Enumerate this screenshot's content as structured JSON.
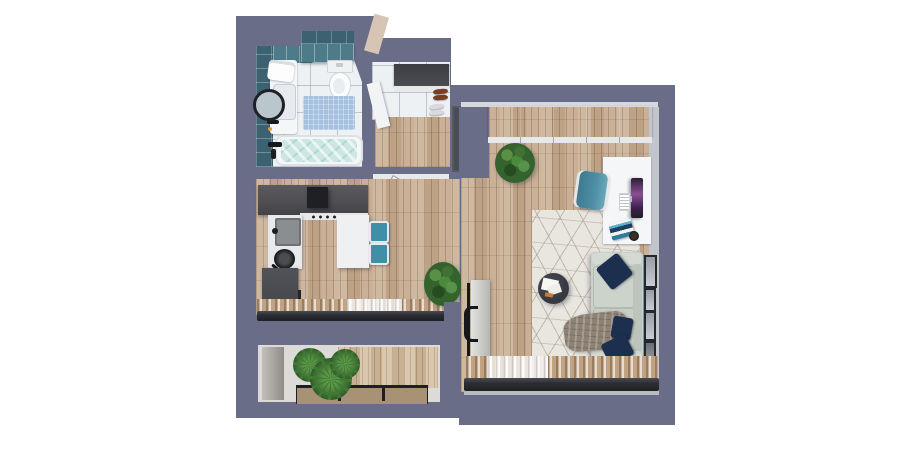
{
  "palette": {
    "background": "#ffffff",
    "wall": "#6a6d88",
    "wall_shadow": "#5d6078",
    "wall_face": "#c3c5cc",
    "trim": "#e7e8ea",
    "cut_beige": "#d6c5b5",
    "wood": "#c7ad92",
    "wood_deck": "#d3bd9f",
    "tile": "#eef1f4",
    "teal_tile": "#3c6272",
    "teal_tile_light": "#4e7b8a",
    "water": "#cde6e3",
    "bath_mat": "#a6c0e0",
    "fixture": "#f4f6f8",
    "counter_dark": "#505054",
    "hood": "#1f2023",
    "cabinet_dark": "#46474b",
    "island": "#eef0f2",
    "stool_teal": "#3f8fa6",
    "curtain_tan": "#c4a98c",
    "curtain_sheer": "#efece7",
    "rail": "#2c2e33",
    "door_dark": "#4b4d55",
    "door_leaf": "#ececee",
    "wardrobe_dark": "#6e7074",
    "entry_shelf_dark": "#4a4c52",
    "rug": "#e9e5df",
    "sofa": "#c9d0c8",
    "pillow_navy": "#1c2f4e",
    "throw": "#8e8274",
    "table_dark": "#35383e",
    "desk": "#f3f4f6",
    "screen_dark": "#1e1f24",
    "screen_purple": "#8a4f93",
    "chair_teal": "#4e8fa6",
    "plant_green": "#2f5a2c",
    "plant_light": "#5a8f46",
    "palm_green": "#3f7a33",
    "planter": "#a79276",
    "shoe_brown": "#7c3c20",
    "shoe_white": "#dadadc",
    "gold": "#d4a33c"
  },
  "plan": {
    "label": "Studio apartment 3D floor plan",
    "rooms": {
      "bathroom": {
        "label": "Bathroom"
      },
      "entry": {
        "label": "Entry hall"
      },
      "kitchen": {
        "label": "Kitchen"
      },
      "living": {
        "label": "Living room"
      },
      "balcony": {
        "label": "Balcony"
      }
    },
    "items": {
      "bathtub": {
        "label": "Bathtub with water"
      },
      "toilet": {
        "label": "Toilet"
      },
      "vanity": {
        "label": "Sink vanity"
      },
      "mirror": {
        "label": "Round mirror"
      },
      "bath_mat": {
        "label": "Blue bath mat"
      },
      "tiled_wall": {
        "label": "Teal tiled wall"
      },
      "entry_wardrobe": {
        "label": "Entry wardrobe with shelf"
      },
      "shoes": {
        "label": "Shoes"
      },
      "entrance_door": {
        "label": "Entrance door"
      },
      "interior_door": {
        "label": "Open interior door"
      },
      "counter": {
        "label": "Kitchen counter"
      },
      "hood": {
        "label": "Cooker hood"
      },
      "kitchen_sink": {
        "label": "Kitchen sink"
      },
      "pan": {
        "label": "Pan on counter"
      },
      "island": {
        "label": "Kitchen island table"
      },
      "stools": {
        "label": "Teal bar stools"
      },
      "kitchen_curtains": {
        "label": "Kitchen window curtains"
      },
      "living_curtains": {
        "label": "Living room window curtains"
      },
      "closet": {
        "label": "Built-in closet"
      },
      "desk": {
        "label": "Desk"
      },
      "monitor": {
        "label": "Monitor"
      },
      "keyboard": {
        "label": "Keyboard"
      },
      "books": {
        "label": "Stack of books"
      },
      "cup": {
        "label": "Cup"
      },
      "desk_chair": {
        "label": "Teal desk chair"
      },
      "rug": {
        "label": "Geometric patterned rug"
      },
      "coffee_table": {
        "label": "Round coffee table with magazines"
      },
      "sofa": {
        "label": "Sofa"
      },
      "pillows": {
        "label": "Navy pillows"
      },
      "throw": {
        "label": "Throw blanket"
      },
      "frames": {
        "label": "Picture frames on wall"
      },
      "tv": {
        "label": "TV panel"
      },
      "plant_large": {
        "label": "Large potted plant"
      },
      "plant_kitchen": {
        "label": "Potted plant"
      },
      "balcony_plants": {
        "label": "Balcony palm plants"
      },
      "planters": {
        "label": "Planter boxes"
      }
    }
  }
}
